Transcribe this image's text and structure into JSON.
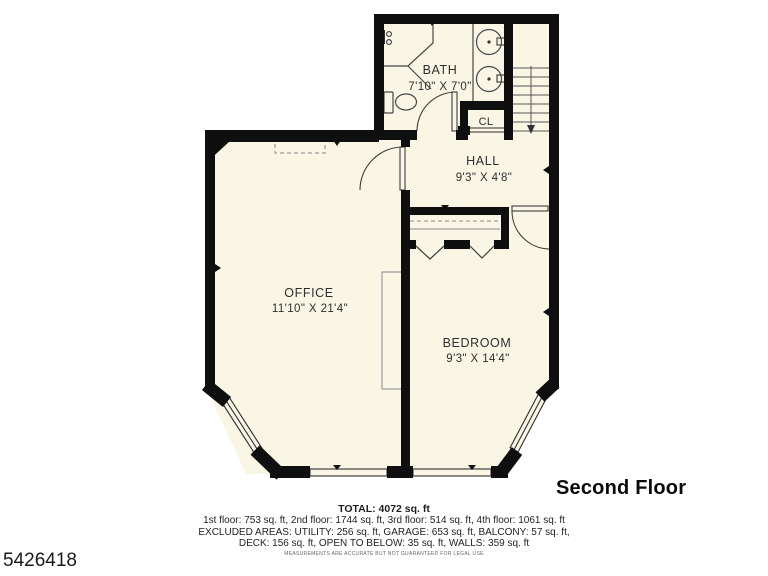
{
  "meta": {
    "photo_id": "5426418",
    "floor_label": "Second Floor",
    "disclaimer": "MEASUREMENTS ARE ACCURATE BUT NOT GUARANTEED FOR LEGAL USE"
  },
  "rooms": [
    {
      "name": "BATH",
      "dims": "7'10\" X 7'0\""
    },
    {
      "name": "CL",
      "dims": ""
    },
    {
      "name": "HALL",
      "dims": "9'3\" X 4'8\""
    },
    {
      "name": "OFFICE",
      "dims": "11'10\" X 21'4\""
    },
    {
      "name": "BEDROOM",
      "dims": "9'3\" X 14'4\""
    }
  ],
  "summary": {
    "total": "TOTAL: 4072 sq. ft",
    "floors": "1st floor: 753 sq. ft, 2nd floor: 1744 sq. ft, 3rd floor: 514 sq. ft, 4th floor: 1061 sq. ft",
    "excluded1": "EXCLUDED AREAS: UTILITY: 256 sq. ft, GARAGE: 653 sq. ft, BALCONY: 57 sq. ft,",
    "excluded2": "DECK: 156 sq. ft, OPEN TO BELOW: 35 sq. ft, WALLS: 359 sq. ft"
  },
  "colors": {
    "floor": "#FAF6E6",
    "wall": "#0f0f0f"
  }
}
